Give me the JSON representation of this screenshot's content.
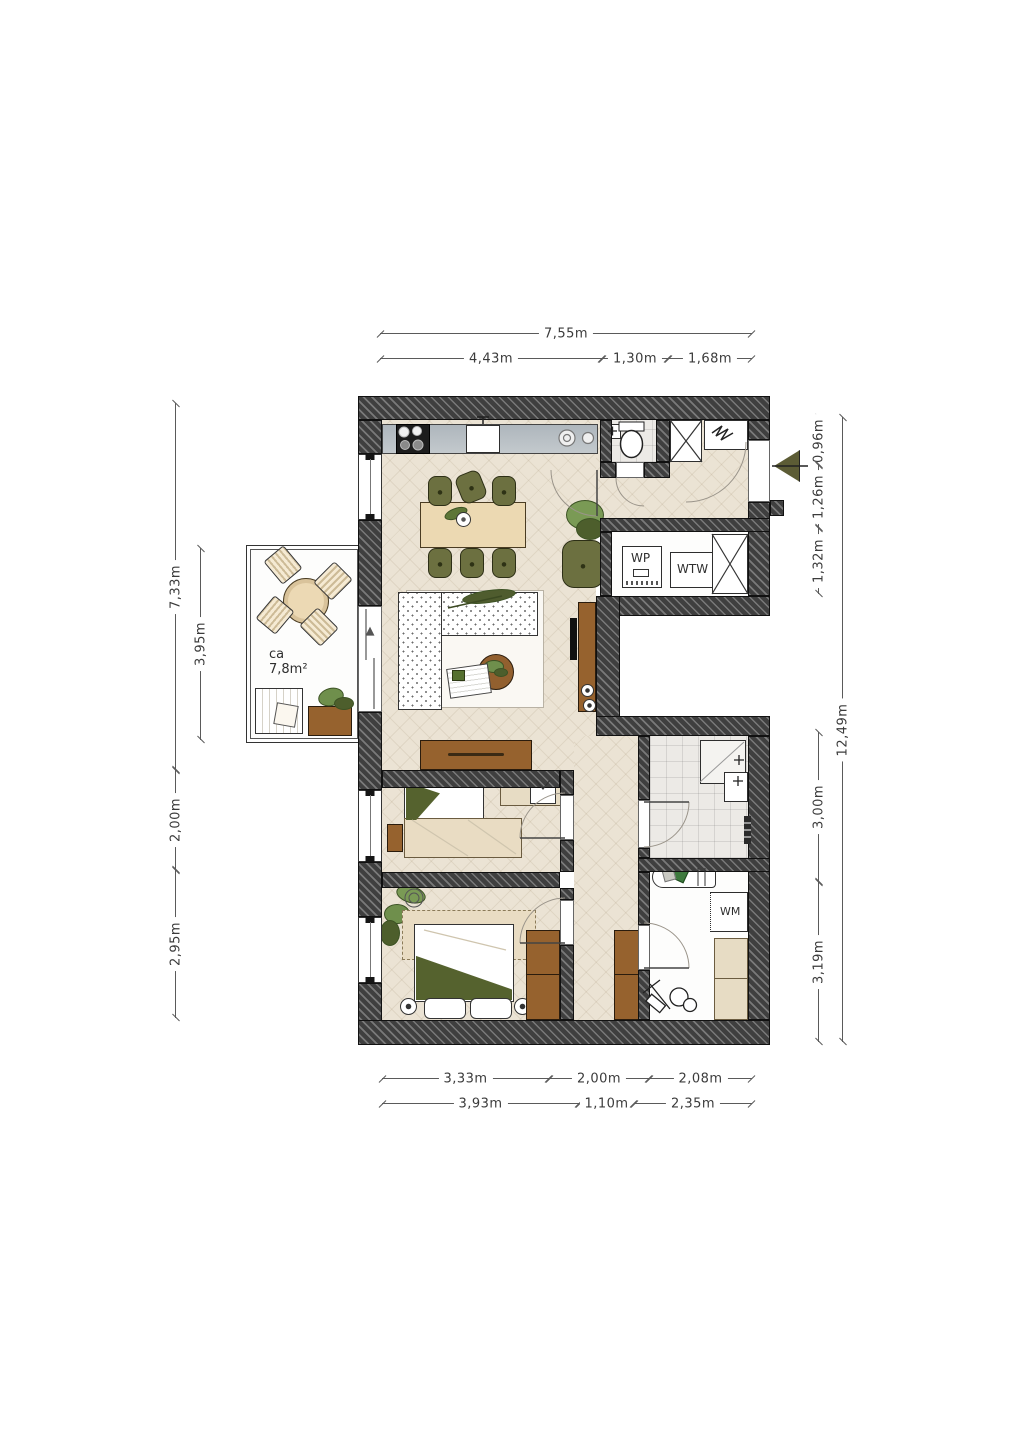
{
  "dimensions": {
    "top": {
      "total": "7,55m",
      "segments": [
        "4,43m",
        "1,30m",
        "1,68m"
      ]
    },
    "bottom": {
      "row1": [
        "3,33m",
        "2,00m",
        "2,08m"
      ],
      "row2": [
        "3,93m",
        "1,10m",
        "2,35m"
      ]
    },
    "left": {
      "segments": [
        "7,33m",
        "2,00m",
        "2,95m"
      ],
      "balcony_depth": "3,95m"
    },
    "right": {
      "total": "12,49m",
      "segments_upper": [
        "0,96m",
        "1,26m",
        "1,32m"
      ],
      "segments_lower": [
        "3,00m",
        "3,19m"
      ]
    }
  },
  "labels": {
    "balcony_circa": "ca",
    "balcony_area": "7,8m²",
    "heat_pump": "WP",
    "heat_recovery_unit": "WTW",
    "washing_machine": "WM"
  },
  "colors": {
    "wall": "#3f3f3f",
    "floor_wood": "#ebe3d4",
    "floor_tile": "#eceae6",
    "wood_dark": "#96622e",
    "wood_light": "#ecd9b2",
    "olive_green": "#6c7040",
    "plant_green": "#6f8f4c",
    "counter_gray": "#b9c0c6",
    "entrance_arrow": "#5c5c35",
    "dimension_text": "#3b3b3b"
  }
}
